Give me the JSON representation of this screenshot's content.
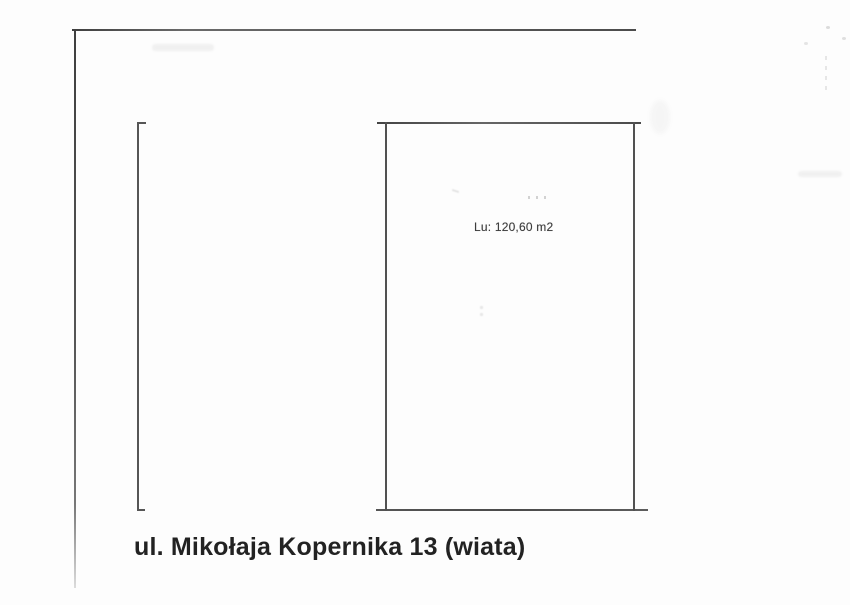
{
  "plan": {
    "area_label": "Lu: 120,60 m2",
    "caption": "ul. Mikołaja Kopernika 13 (wiata)",
    "colors": {
      "paper": "#fdfdfd",
      "line": "#4f4f4f",
      "frame_line": "#5c5c5c",
      "text": "#222222",
      "label_text": "#3d3d3d"
    }
  }
}
